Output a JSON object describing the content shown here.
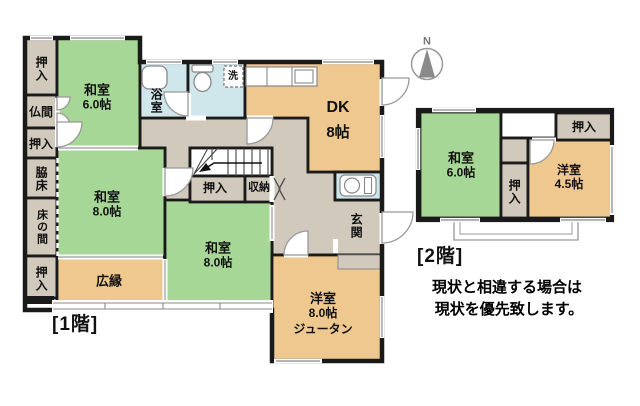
{
  "compass": {
    "label": "N"
  },
  "floor1": {
    "caption": "[1階]",
    "left_column": [
      "押入",
      "仏間",
      "押入",
      "脇床",
      "床の間",
      "押入"
    ],
    "rooms": {
      "washitsu6": {
        "name": "和室",
        "size": "6.0帖"
      },
      "bath": "浴室",
      "laundry": "洗",
      "dk": {
        "name": "DK",
        "size": "8帖"
      },
      "washitsu8_left": {
        "name": "和室",
        "size": "8.0帖"
      },
      "hiroen": "広縁",
      "stairs_closet": "押入",
      "storage": "収納",
      "washitsu8_center": {
        "name": "和室",
        "size": "8.0帖"
      },
      "genkan": "玄関",
      "youshitsu8": {
        "name": "洋室",
        "size": "8.0帖",
        "note": "ジュータン"
      }
    }
  },
  "floor2": {
    "caption": "[2階]",
    "rooms": {
      "washitsu6": {
        "name": "和室",
        "size": "6.0帖"
      },
      "closet_top": "押入",
      "closet_mid": "押入",
      "youshitsu45": {
        "name": "洋室",
        "size": "4.5帖"
      }
    }
  },
  "notes": [
    "現状と相違する場合は",
    "現状を優先致します。"
  ],
  "colors": {
    "tatami_green": "#a6d796",
    "wood_tan": "#eec88f",
    "wet_blue": "#cfe6ea",
    "hall_gray": "#d0c9bc",
    "wall": "#1a1a1a"
  }
}
